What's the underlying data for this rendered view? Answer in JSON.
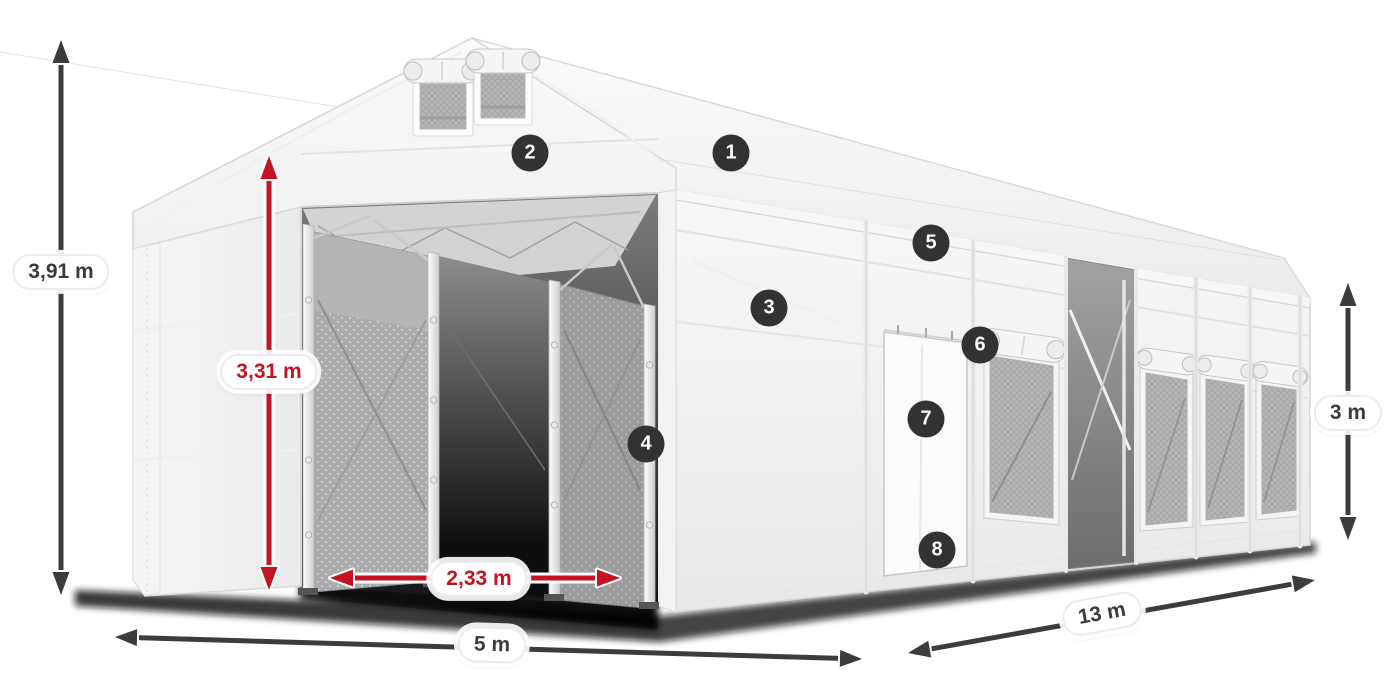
{
  "dimensions": {
    "total_height": "3,91 m",
    "inner_height": "3,31 m",
    "entrance_width": "2,33 m",
    "front_width": "5 m",
    "side_length": "13 m",
    "side_height": "3 m"
  },
  "callouts": [
    "1",
    "2",
    "3",
    "4",
    "5",
    "6",
    "7",
    "8"
  ],
  "colors": {
    "canvas_bg": "#ffffff",
    "dimension_dark": "#3c3c3c",
    "accent_red": "#c51322",
    "badge_bg": "#323232",
    "badge_text": "#ffffff"
  }
}
